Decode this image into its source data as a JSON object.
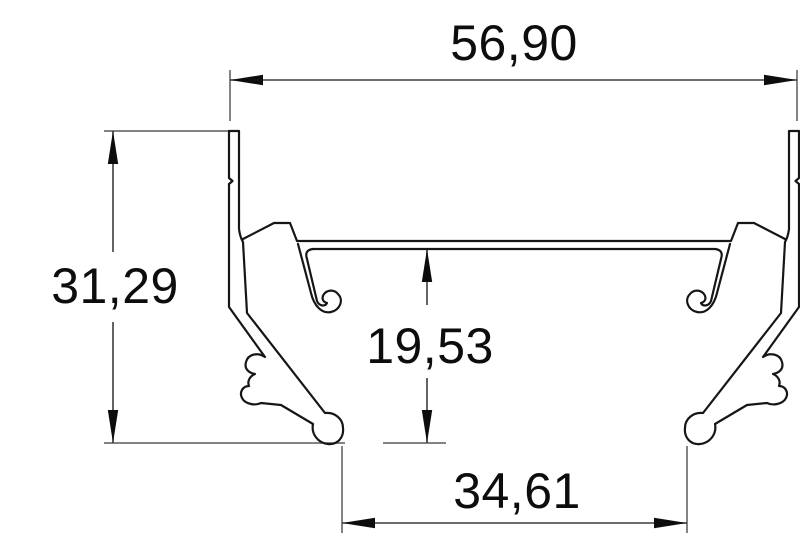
{
  "drawing": {
    "type": "technical-cross-section",
    "subject": "extruded-profile-cross-section",
    "dimensions": {
      "overall_width": {
        "label": "56,90"
      },
      "overall_height": {
        "label": "31,29"
      },
      "inner_height": {
        "label": "19,53"
      },
      "bottom_opening_width": {
        "label": "34,61"
      }
    },
    "colors": {
      "background": "#ffffff",
      "profile_line": "#161616",
      "dimension_line": "#3d3d3d",
      "text": "#0d0d0d"
    }
  }
}
